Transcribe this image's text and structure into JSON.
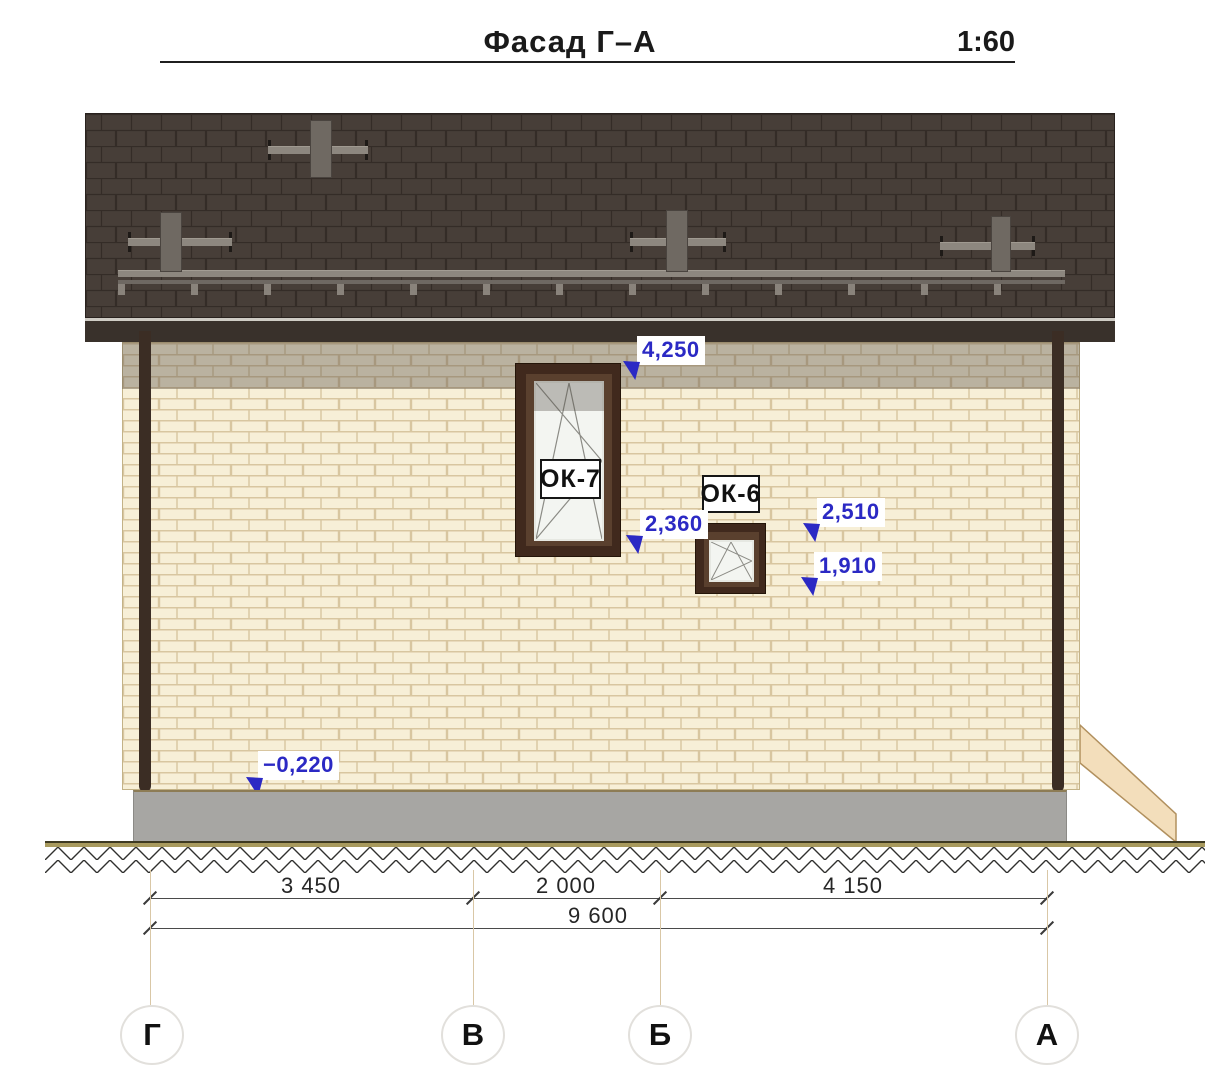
{
  "header": {
    "title": "Фасад Г–А",
    "scale": "1:60"
  },
  "windows": {
    "ok7": {
      "label": "ОК-7"
    },
    "ok6": {
      "label": "ОК-6"
    }
  },
  "elevation_marks": [
    {
      "id": "eave-level",
      "value": "4,250"
    },
    {
      "id": "ok7-sill-level",
      "value": "2,360"
    },
    {
      "id": "ok6-head-level",
      "value": "2,510"
    },
    {
      "id": "ok6-sill-level",
      "value": "1,910"
    },
    {
      "id": "plinth-level",
      "value": "−0,220"
    }
  ],
  "dimensions": {
    "segments": [
      {
        "from": "Г",
        "to": "В",
        "label": "3 450"
      },
      {
        "from": "В",
        "to": "Б",
        "label": "2 000"
      },
      {
        "from": "Б",
        "to": "А",
        "label": "4 150"
      }
    ],
    "total": {
      "from": "Г",
      "to": "А",
      "label": "9 600"
    }
  },
  "axes": [
    {
      "label": "Г"
    },
    {
      "label": "В"
    },
    {
      "label": "Б"
    },
    {
      "label": "А"
    }
  ],
  "colors": {
    "accent_blue": "#2b29c4",
    "roof": "#473e38",
    "wall_brick": "#f7efd7",
    "foundation": "#a7a6a3",
    "window_frame": "#40291d"
  }
}
